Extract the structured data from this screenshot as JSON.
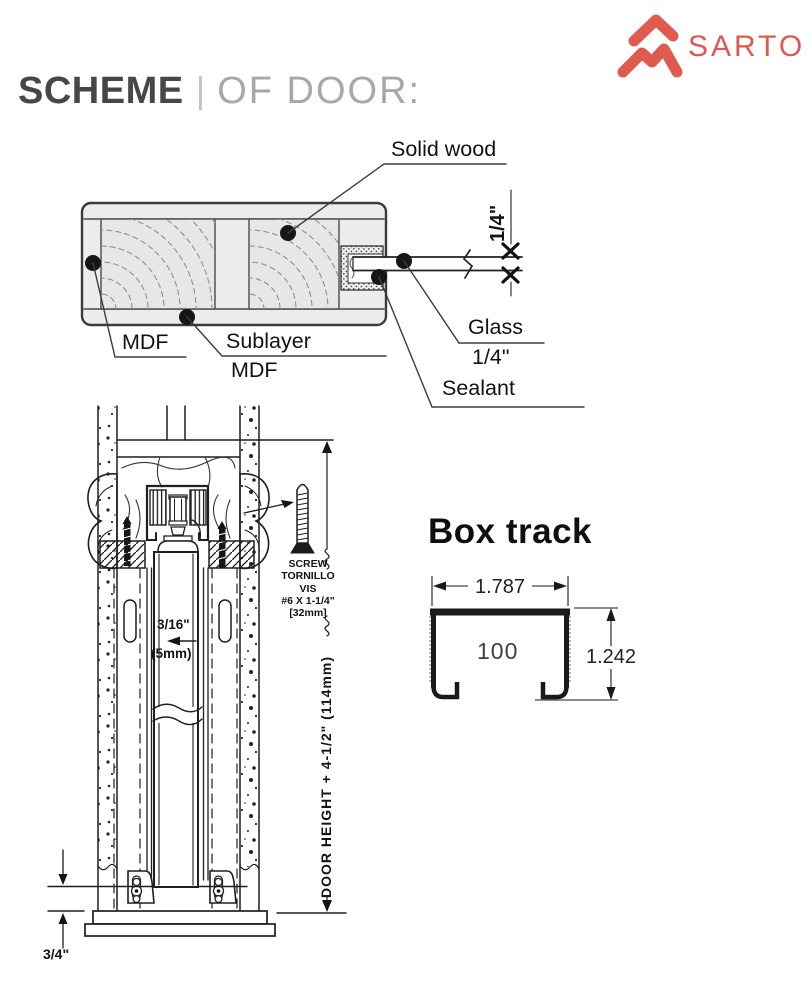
{
  "header": {
    "title_primary": "SCHEME",
    "title_divider": "|",
    "title_secondary": "OF DOOR:"
  },
  "brand": {
    "name": "SARTO",
    "color": "#dd5a50"
  },
  "door_cross_section": {
    "labels": {
      "solid_wood": "Solid wood",
      "mdf": "MDF",
      "sublayer_top": "Sublayer",
      "sublayer_bottom": "MDF",
      "glass_top": "Glass",
      "glass_bottom": "1/4\"",
      "sealant": "Sealant"
    },
    "dimensions": {
      "glass_thickness": "1/4\""
    }
  },
  "track_mechanism": {
    "screw_note": {
      "line1": "SCREW",
      "line2": "TORNILLO",
      "line3": "VIS",
      "line4": "#6 X 1-1/4\"",
      "line5": "[32mm]"
    },
    "gap_dimension": {
      "inches": "3/16\"",
      "metric": "(5mm)"
    },
    "height_dimension": "DOOR HEIGHT + 4-1/2\" (114mm)",
    "floor_clearance": "3/4\""
  },
  "box_track": {
    "title": "Box track",
    "width": "1.787",
    "model": "100",
    "height": "1.242"
  }
}
